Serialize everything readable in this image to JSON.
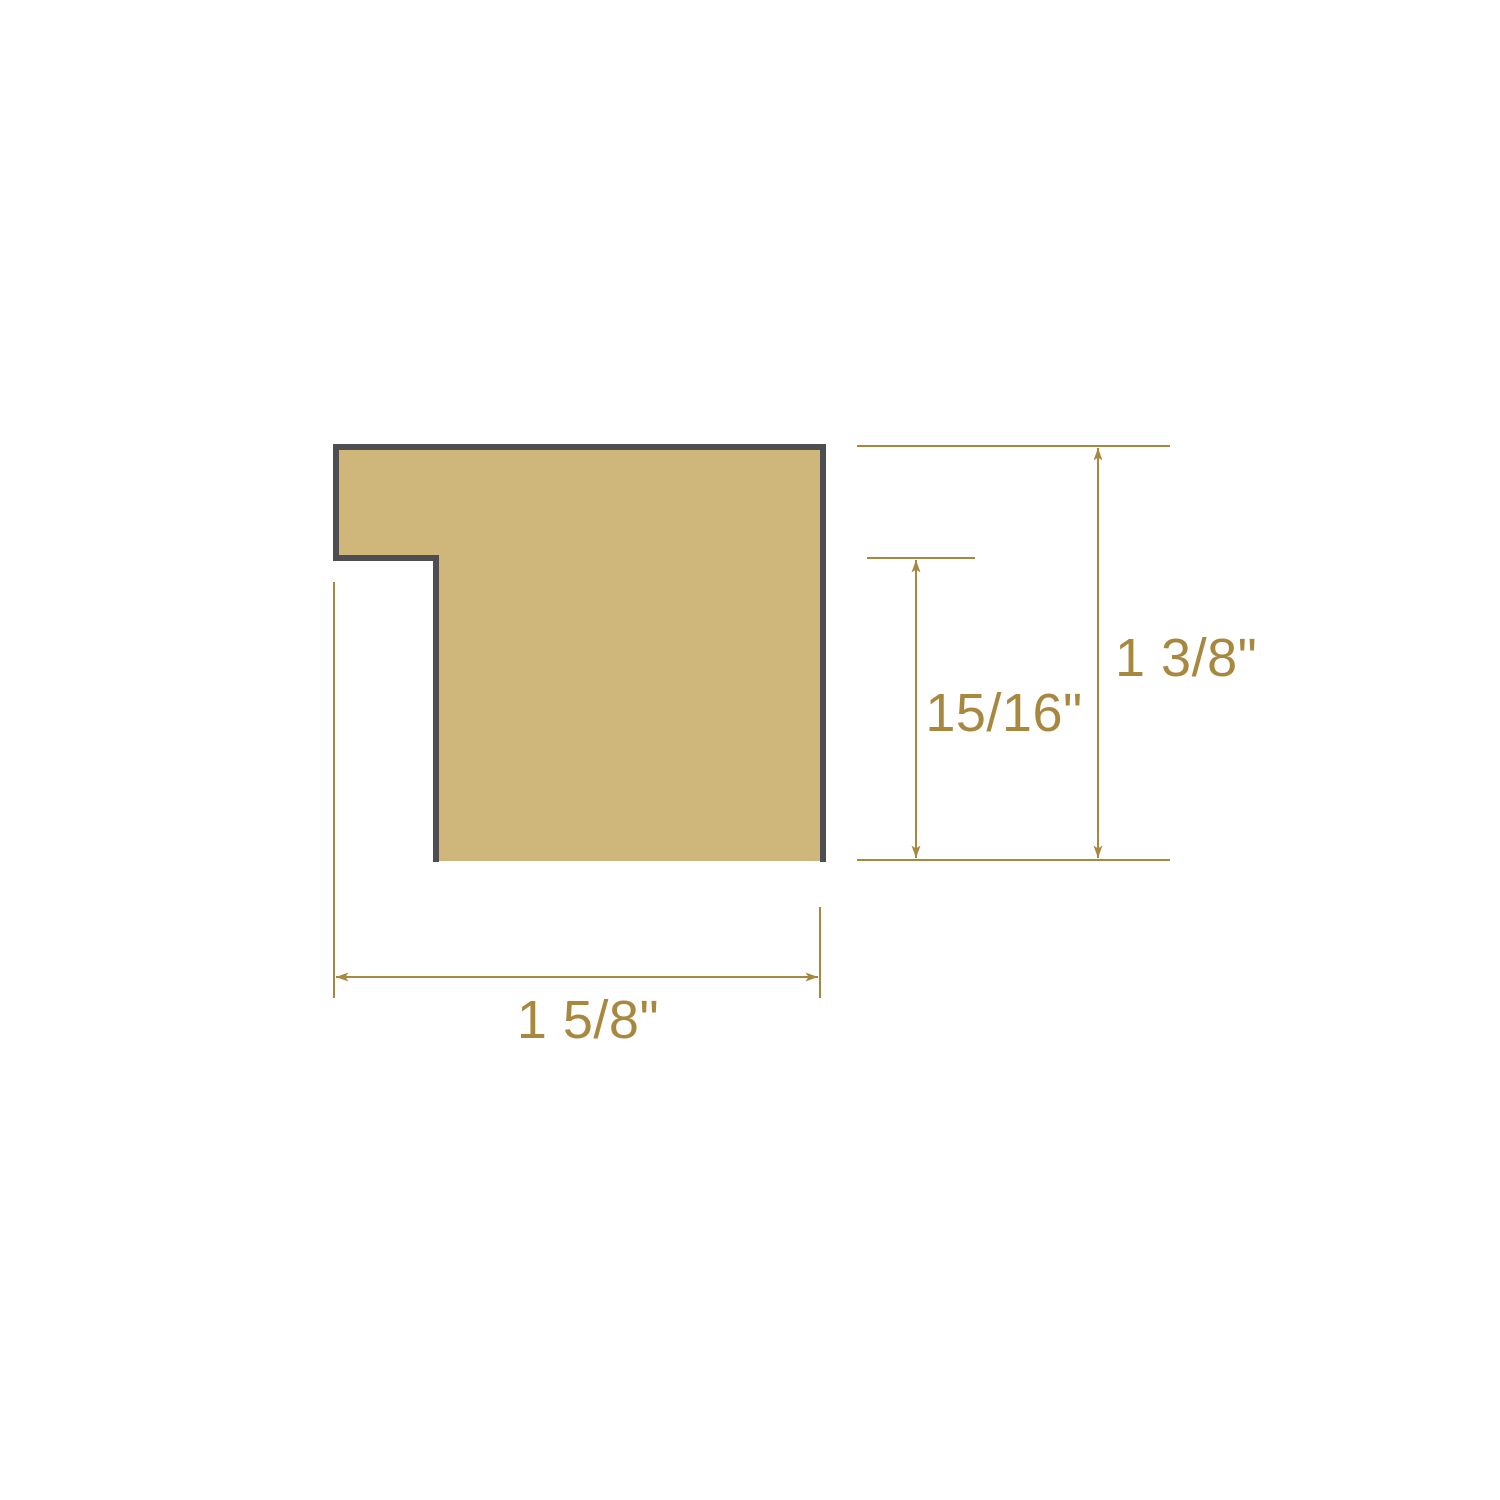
{
  "diagram": {
    "type": "picture-frame-moulding-cross-section",
    "labels": {
      "width": "1 5/8\"",
      "overall_height": "1 3/8\"",
      "inner_height": "15/16\""
    },
    "colors": {
      "profile_fill": "#CFB67B",
      "profile_outline": "#4E4E52",
      "dimension": "#A8873F",
      "background": "#FFFFFF"
    }
  }
}
